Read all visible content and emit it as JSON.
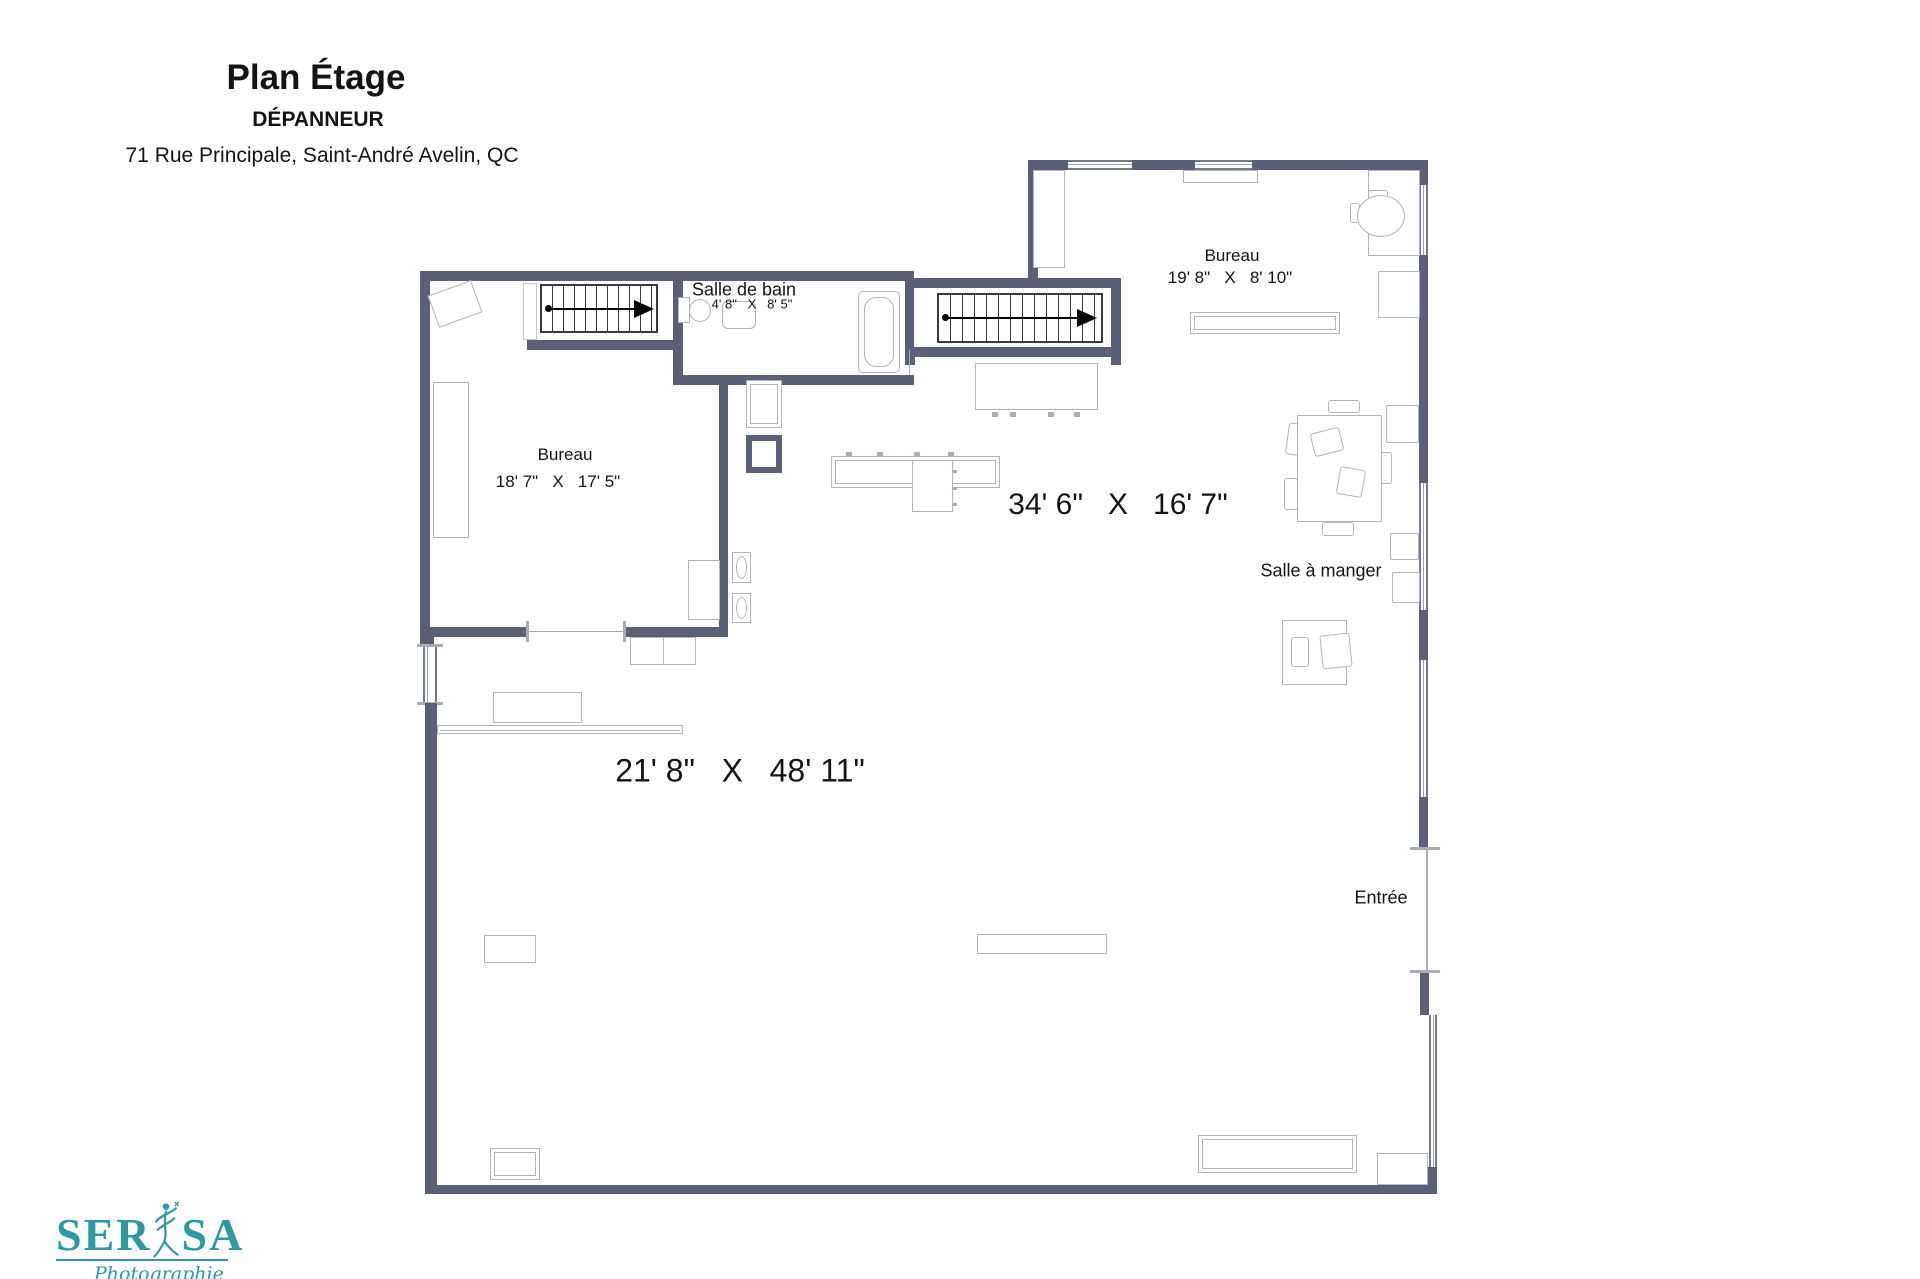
{
  "header": {
    "title": "Plan Étage",
    "subtitle": "DÉPANNEUR",
    "address": "71 Rue Principale, Saint-André Avelin, QC"
  },
  "rooms": {
    "bureau_left": {
      "name": "Bureau",
      "dims": "18' 7\"   X   17' 5\""
    },
    "bureau_top_right": {
      "name": "Bureau",
      "dims": "19' 8\"   X   8' 10\""
    },
    "salle_de_bain": {
      "name": "Salle de bain",
      "dims": "4' 8\"   X   8' 5\""
    },
    "main_area": {
      "dims": "34' 6\"   X   16' 7\""
    },
    "salle_a_manger": {
      "name": "Salle à manger"
    },
    "entree": {
      "name": "Entrée"
    },
    "grande_salle": {
      "dims": "21' 8\"   X   48' 11\""
    }
  },
  "logo": {
    "brand_left": "SER",
    "brand_right": "SA",
    "tagline": "Photographie"
  },
  "colors": {
    "wall": "#5b6076",
    "furniture_outline": "#b2b5c0",
    "stair": "#3a3a3a",
    "logo_teal": "#2d9aa1",
    "text": "#141414"
  }
}
